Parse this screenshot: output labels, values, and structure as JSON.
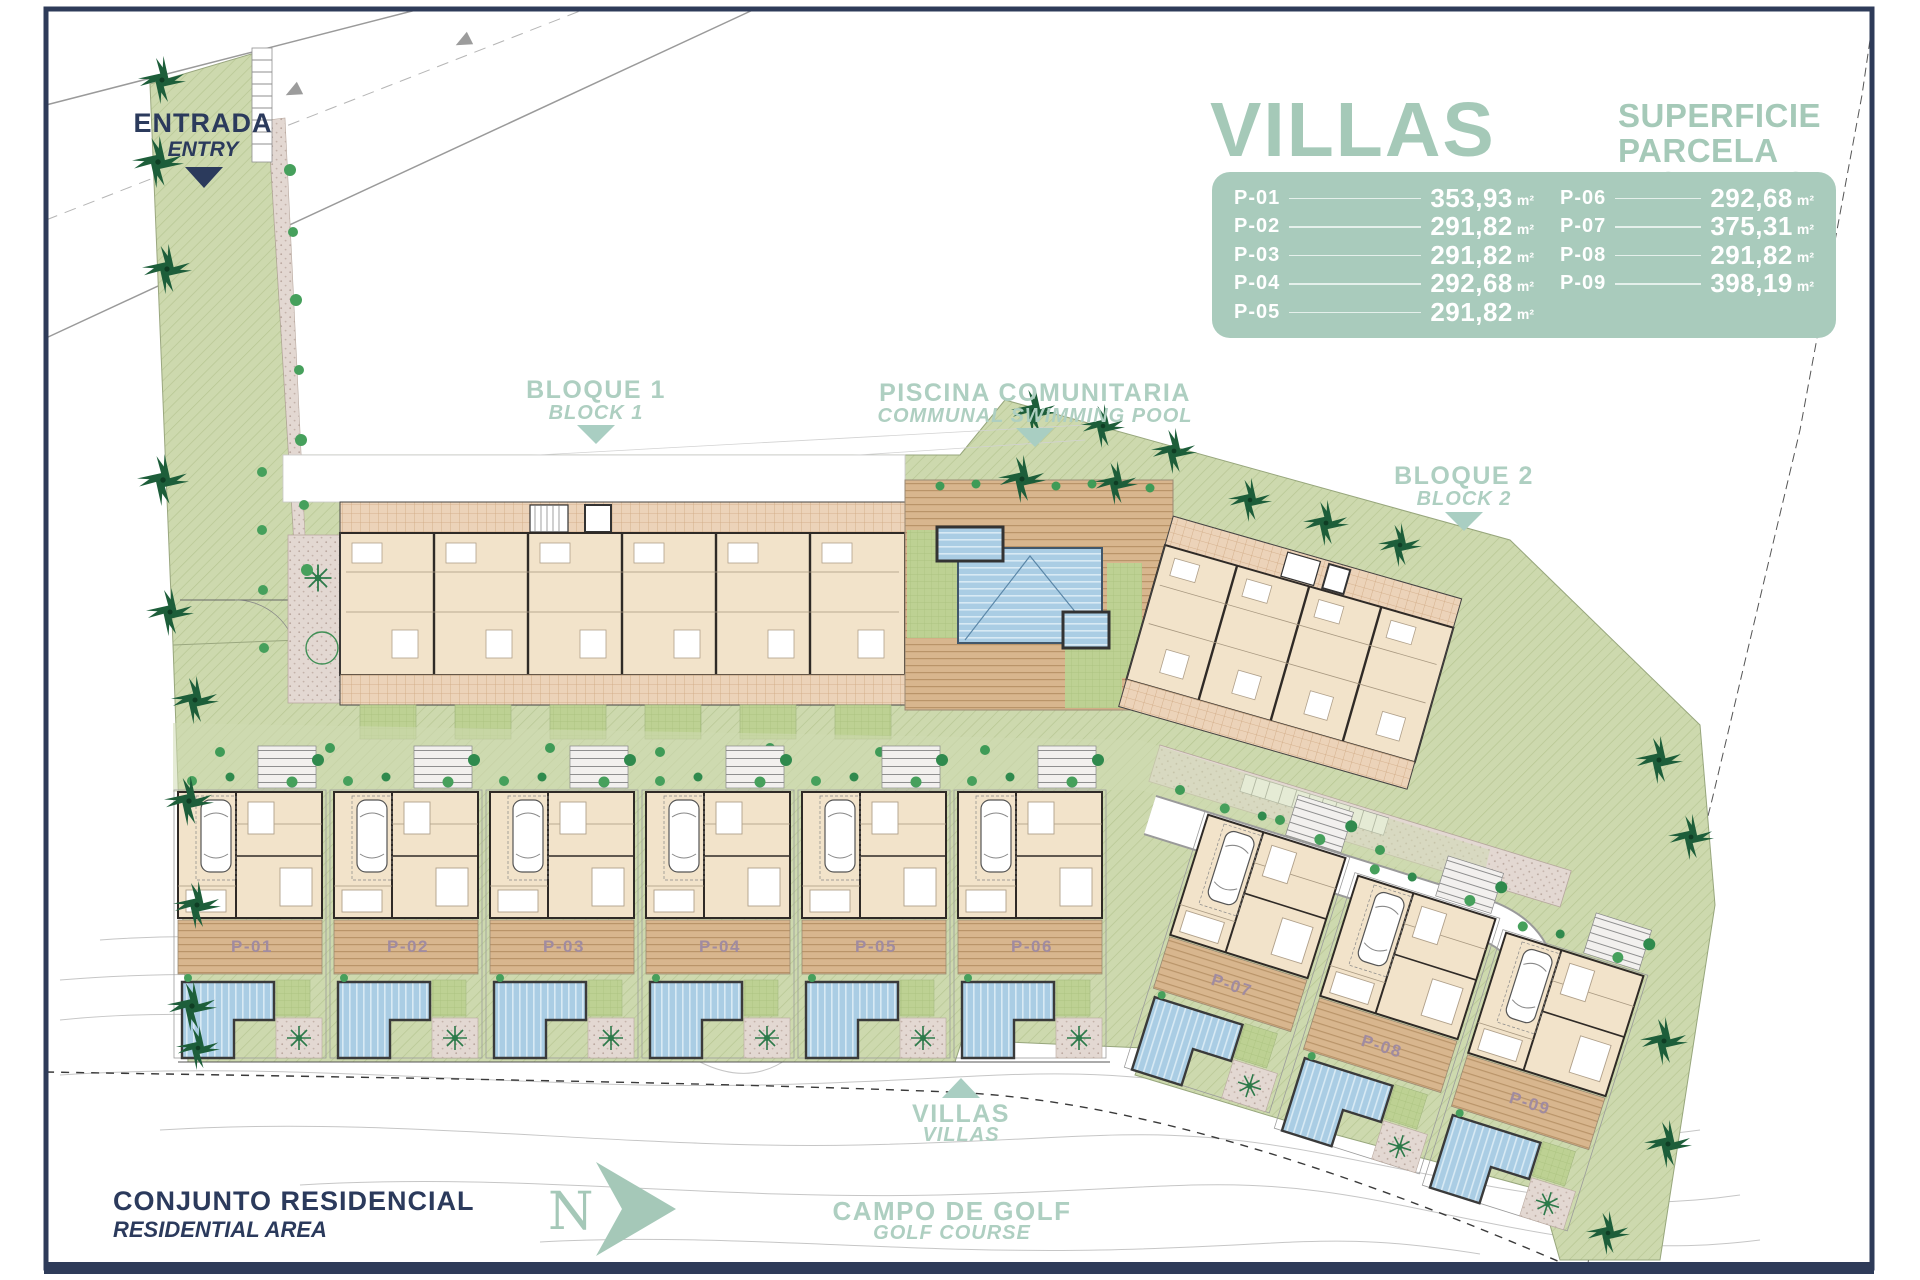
{
  "legend": {
    "title": "VILLAS",
    "subtitle_es": "SUPERFICIE PARCELA",
    "subtitle_en": "PLOT AREAS",
    "unit": "m²",
    "plots": [
      {
        "id": "P-01",
        "area": "353,93"
      },
      {
        "id": "P-02",
        "area": "291,82"
      },
      {
        "id": "P-03",
        "area": "291,82"
      },
      {
        "id": "P-04",
        "area": "292,68"
      },
      {
        "id": "P-05",
        "area": "291,82"
      },
      {
        "id": "P-06",
        "area": "292,68"
      },
      {
        "id": "P-07",
        "area": "375,31"
      },
      {
        "id": "P-08",
        "area": "291,82"
      },
      {
        "id": "P-09",
        "area": "398,19"
      }
    ]
  },
  "plan_labels": {
    "entrada_es": "ENTRADA",
    "entrada_en": "ENTRY",
    "bloque1_es": "BLOQUE 1",
    "bloque1_en": "BLOCK 1",
    "piscina_es": "PISCINA COMUNITARIA",
    "piscina_en": "COMMUNAL SWIMMING POOL",
    "bloque2_es": "BLOQUE 2",
    "bloque2_en": "BLOCK 2",
    "villas_es": "VILLAS",
    "villas_en": "VILLAS",
    "conjunto_es": "CONJUNTO RESIDENCIAL",
    "conjunto_en": "RESIDENTIAL AREA",
    "campo_es": "CAMPO DE GOLF",
    "campo_en": "GOLF COURSE",
    "north": "N"
  },
  "plot_tags": [
    "P-01",
    "P-02",
    "P-03",
    "P-04",
    "P-05",
    "P-06",
    "P-07",
    "P-08",
    "P-09"
  ],
  "colors": {
    "frame_navy": "#2e3b59",
    "label_sage": "#a9cec2",
    "legend_panel": "#a9cbbc",
    "text_navy": "#2b3a5c",
    "site_green": "#cdd9ae",
    "lawn_green": "#bdd193",
    "building_beige": "#f2e3ca",
    "wall_dark": "#2f2a26",
    "deck_tan": "#d8b68e",
    "pool_blue": "#aacde4",
    "gravel": "#e3d8d2",
    "plot_tag": "#a08ba0",
    "palm_green": "#1d5e3a",
    "contour_gray": "#c6c6c6"
  }
}
